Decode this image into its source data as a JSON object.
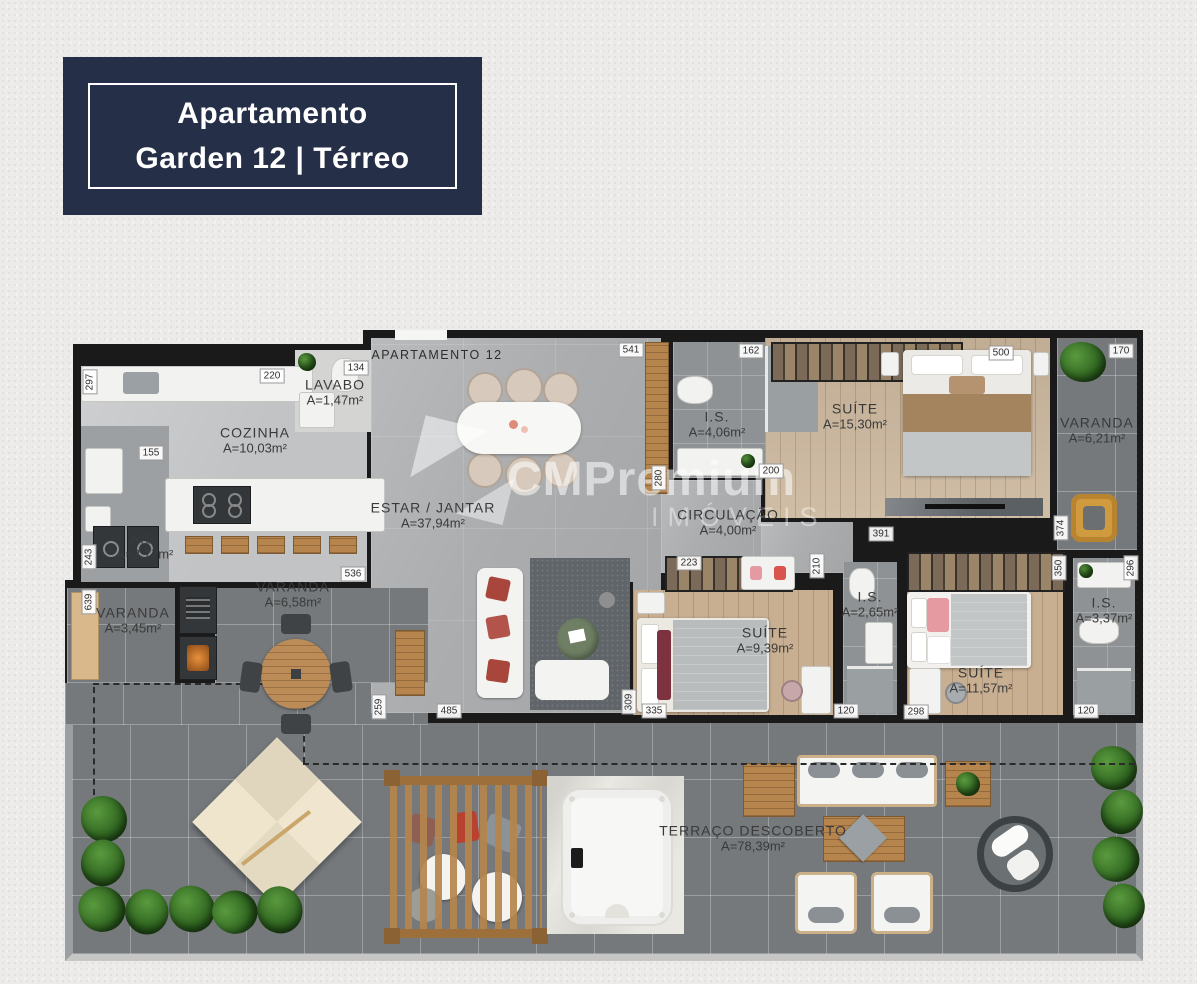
{
  "title_badge": {
    "line1": "Apartamento",
    "line2": "Garden 12 | Térreo"
  },
  "unit_label": {
    "text": "APARTAMENTO 12"
  },
  "watermark": {
    "brand": "CMPremium",
    "sub": "IMÓVEIS"
  },
  "rooms": [
    {
      "name": "LAVABO",
      "area": "A=1,47m²",
      "x": 270,
      "y": 62
    },
    {
      "name": "COZINHA",
      "area": "A=10,03m²",
      "x": 190,
      "y": 110
    },
    {
      "name": "ESTAR / JANTAR",
      "area": "A=37,94m²",
      "x": 368,
      "y": 185
    },
    {
      "name": "I.S.",
      "area": "A=4,06m²",
      "x": 652,
      "y": 94
    },
    {
      "name": "CIRCULAÇÃO",
      "area": "A=4,00m²",
      "x": 663,
      "y": 192
    },
    {
      "name": "SUÍTE",
      "area": "A=15,30m²",
      "x": 790,
      "y": 86
    },
    {
      "name": "VARANDA",
      "area": "A=6,21m²",
      "x": 1032,
      "y": 100
    },
    {
      "name": "A.S.",
      "area": "A=3,77m²",
      "x": 80,
      "y": 216
    },
    {
      "name": "VARANDA",
      "area": "A=3,45m²",
      "x": 68,
      "y": 290
    },
    {
      "name": "VARANDA",
      "area": "A=6,58m²",
      "x": 228,
      "y": 264
    },
    {
      "name": "SUÍTE",
      "area": "A=9,39m²",
      "x": 700,
      "y": 310
    },
    {
      "name": "I.S.",
      "area": "A=2,65m²",
      "x": 805,
      "y": 274
    },
    {
      "name": "SUÍTE",
      "area": "A=11,57m²",
      "x": 916,
      "y": 350
    },
    {
      "name": "I.S.",
      "area": "A=3,37m²",
      "x": 1039,
      "y": 280
    },
    {
      "name": "TERRAÇO DESCOBERTO",
      "area": "A=78,39m²",
      "x": 688,
      "y": 508
    }
  ],
  "dimensions": [
    {
      "v": "297",
      "x": 25,
      "y": 52,
      "r": 1
    },
    {
      "v": "220",
      "x": 207,
      "y": 46
    },
    {
      "v": "134",
      "x": 291,
      "y": 38
    },
    {
      "v": "541",
      "x": 566,
      "y": 20
    },
    {
      "v": "162",
      "x": 686,
      "y": 21
    },
    {
      "v": "500",
      "x": 936,
      "y": 23
    },
    {
      "v": "170",
      "x": 1056,
      "y": 21
    },
    {
      "v": "155",
      "x": 86,
      "y": 123
    },
    {
      "v": "243",
      "x": 24,
      "y": 227,
      "r": 1
    },
    {
      "v": "639",
      "x": 24,
      "y": 272,
      "r": 1
    },
    {
      "v": "536",
      "x": 288,
      "y": 244
    },
    {
      "v": "259",
      "x": 314,
      "y": 377,
      "r": 1
    },
    {
      "v": "485",
      "x": 384,
      "y": 381
    },
    {
      "v": "309",
      "x": 564,
      "y": 372,
      "r": 1
    },
    {
      "v": "335",
      "x": 589,
      "y": 381
    },
    {
      "v": "120",
      "x": 781,
      "y": 381
    },
    {
      "v": "298",
      "x": 851,
      "y": 382
    },
    {
      "v": "120",
      "x": 1021,
      "y": 381
    },
    {
      "v": "223",
      "x": 624,
      "y": 233
    },
    {
      "v": "200",
      "x": 706,
      "y": 141
    },
    {
      "v": "280",
      "x": 594,
      "y": 148,
      "r": 1
    },
    {
      "v": "210",
      "x": 752,
      "y": 236,
      "r": 1
    },
    {
      "v": "391",
      "x": 816,
      "y": 204
    },
    {
      "v": "374",
      "x": 996,
      "y": 198,
      "r": 1
    },
    {
      "v": "350",
      "x": 994,
      "y": 238,
      "r": 1
    },
    {
      "v": "296",
      "x": 1066,
      "y": 238,
      "r": 1
    }
  ],
  "colors": {
    "badge_bg": "#252f47",
    "wall": "#1a1a1a",
    "wood": "#cbb69c",
    "tile": "#75797c",
    "plant": "#2e641f",
    "accent_red": "#a8463c",
    "mustard": "#d09a3e",
    "pink": "#e59aa2",
    "umbrella": "#ece2ca"
  }
}
